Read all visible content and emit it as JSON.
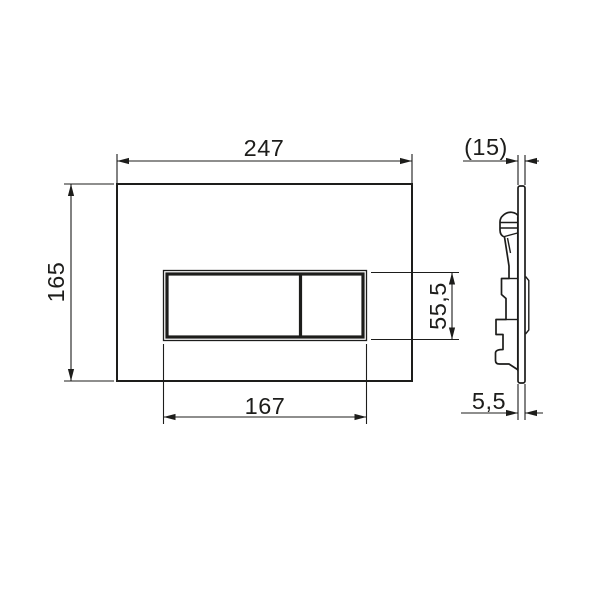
{
  "colors": {
    "ink": "#1d1d1b",
    "paper": "#ffffff"
  },
  "front_view": {
    "plate_width_label": "247",
    "plate_height_label": "165",
    "button_width_label": "167",
    "button_height_label": "55,5"
  },
  "side_view": {
    "overall_depth_label": "(15)",
    "plate_thickness_label": "5,5"
  }
}
